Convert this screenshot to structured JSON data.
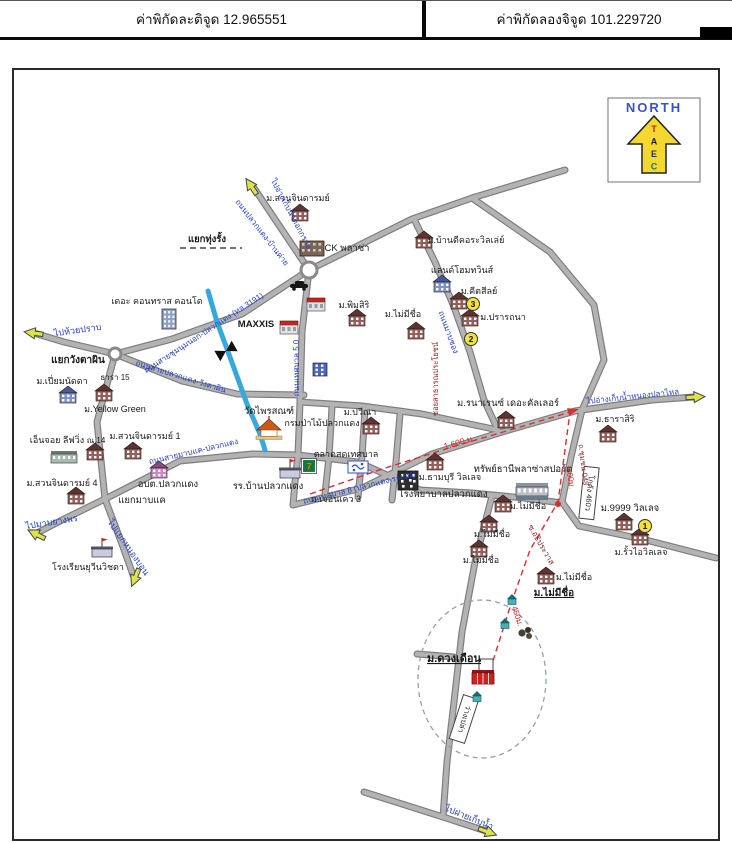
{
  "header": {
    "lat": "ค่าพิกัดละติจูด 12.965551",
    "lon": "ค่าพิกัดลองจิจูด 101.229720"
  },
  "north_box": {
    "title": "NORTH",
    "title_color": "#3a50c8",
    "arrow_color": "#f4d830",
    "letters": [
      "T",
      "A",
      "E",
      "C"
    ],
    "letter_colors": [
      "#c22222",
      "#222222",
      "#223366",
      "#0a7a7a"
    ]
  },
  "map": {
    "colors": {
      "road_fill": "#b3b3b3",
      "road_edge": "#7e7e7e",
      "stream": "#35a8de",
      "blue_text": "#2440c8",
      "maroon_text": "#8a2a2a",
      "red_text": "#e02020",
      "black_text": "#1a1a1a",
      "route_dash": "#d63030",
      "circle_dash": "#8fa0b4",
      "arrow_fill": "#dbe24c",
      "badge_fill": "#f2e23a"
    },
    "roads": [
      {
        "pts": [
          [
            563,
            168
          ],
          [
            470,
            196
          ],
          [
            410,
            217
          ],
          [
            307,
            268
          ]
        ]
      },
      {
        "pts": [
          [
            252,
            186
          ],
          [
            307,
            268
          ]
        ]
      },
      {
        "pts": [
          [
            307,
            268
          ],
          [
            240,
            312
          ],
          [
            170,
            337
          ],
          [
            113,
            352
          ]
        ]
      },
      {
        "pts": [
          [
            113,
            352
          ],
          [
            62,
            340
          ],
          [
            32,
            331
          ]
        ]
      },
      {
        "pts": [
          [
            113,
            352
          ],
          [
            95,
            420
          ],
          [
            103,
            497
          ]
        ]
      },
      {
        "pts": [
          [
            103,
            497
          ],
          [
            62,
            517
          ],
          [
            35,
            531
          ]
        ]
      },
      {
        "pts": [
          [
            103,
            497
          ],
          [
            120,
            542
          ],
          [
            131,
            573
          ]
        ]
      },
      {
        "pts": [
          [
            103,
            497
          ],
          [
            178,
            459
          ],
          [
            250,
            452
          ],
          [
            298,
            453
          ]
        ]
      },
      {
        "pts": [
          [
            113,
            352
          ],
          [
            180,
            379
          ],
          [
            235,
            392
          ],
          [
            302,
            393
          ]
        ]
      },
      {
        "pts": [
          [
            307,
            268
          ],
          [
            300,
            330
          ],
          [
            298,
            400
          ],
          [
            296,
            453
          ],
          [
            293,
            480
          ],
          [
            291,
            503
          ]
        ]
      },
      {
        "pts": [
          [
            291,
            503
          ],
          [
            360,
            486
          ],
          [
            430,
            452
          ],
          [
            500,
            430
          ],
          [
            573,
            409
          ],
          [
            650,
            398
          ],
          [
            692,
            395
          ]
        ]
      },
      {
        "pts": [
          [
            412,
            217
          ],
          [
            433,
            260
          ],
          [
            452,
            305
          ],
          [
            468,
            350
          ],
          [
            482,
            398
          ],
          [
            496,
            428
          ]
        ]
      },
      {
        "pts": [
          [
            470,
            196
          ],
          [
            548,
            250
          ],
          [
            592,
            303
          ],
          [
            602,
            358
          ],
          [
            580,
            408
          ]
        ]
      },
      {
        "pts": [
          [
            580,
            408
          ],
          [
            569,
            455
          ],
          [
            560,
            500
          ]
        ]
      },
      {
        "pts": [
          [
            560,
            500
          ],
          [
            577,
            524
          ],
          [
            640,
            537
          ],
          [
            714,
            556
          ]
        ]
      },
      {
        "pts": [
          [
            490,
            494
          ],
          [
            473,
            560
          ],
          [
            460,
            630
          ],
          [
            452,
            700
          ],
          [
            445,
            760
          ],
          [
            441,
            815
          ]
        ]
      },
      {
        "pts": [
          [
            418,
            488
          ],
          [
            470,
            491
          ],
          [
            522,
            496
          ],
          [
            560,
            501
          ]
        ]
      },
      {
        "pts": [
          [
            362,
            790
          ],
          [
            441,
            815
          ],
          [
            484,
            829
          ]
        ]
      },
      {
        "pts": [
          [
            452,
            655
          ],
          [
            415,
            652
          ]
        ]
      },
      {
        "pts": [
          [
            298,
            400
          ],
          [
            360,
            404
          ],
          [
            420,
            412
          ],
          [
            496,
            428
          ]
        ]
      },
      {
        "pts": [
          [
            330,
            405
          ],
          [
            327,
            455
          ],
          [
            323,
            492
          ]
        ]
      },
      {
        "pts": [
          [
            363,
            408
          ],
          [
            360,
            455
          ],
          [
            356,
            495
          ]
        ]
      },
      {
        "pts": [
          [
            398,
            412
          ],
          [
            394,
            460
          ],
          [
            390,
            498
          ]
        ]
      },
      {
        "pts": [
          [
            296,
            453
          ],
          [
            356,
            460
          ],
          [
            418,
            488
          ]
        ]
      }
    ],
    "stream": {
      "pts": [
        [
          206,
          289
        ],
        [
          215,
          320
        ],
        [
          228,
          355
        ],
        [
          245,
          402
        ],
        [
          258,
          432
        ],
        [
          263,
          448
        ]
      ]
    },
    "bridge": {
      "x": 224,
      "y": 349,
      "a": -30
    },
    "junctions": [
      {
        "x": 307,
        "y": 268,
        "r": 8
      },
      {
        "x": 113,
        "y": 352,
        "r": 6
      }
    ],
    "dash_circle": {
      "cx": 480,
      "cy": 677,
      "rx": 64,
      "ry": 79
    },
    "route": {
      "pts": [
        [
          308,
          492
        ],
        [
          380,
          467
        ],
        [
          450,
          445
        ],
        [
          525,
          423
        ],
        [
          568,
          410
        ],
        [
          562,
          455
        ],
        [
          556,
          500
        ],
        [
          528,
          548
        ],
        [
          509,
          602
        ],
        [
          490,
          662
        ],
        [
          486,
          674
        ]
      ],
      "dot": {
        "x": 556,
        "y": 502
      },
      "heads": [
        {
          "x": 570,
          "y": 409,
          "a": -15
        },
        {
          "x": 487,
          "y": 678,
          "a": 195
        }
      ]
    },
    "extras": {
      "dash_underline": [
        [
          178,
          246
        ],
        [
          240,
          246
        ]
      ]
    },
    "boxes": [
      {
        "t": "โกดัง 460ว",
        "x": 587,
        "y": 491,
        "w": 15,
        "h": 52,
        "r": 6
      },
      {
        "t": "ว่างเปล่า",
        "x": 462,
        "y": 717,
        "w": 16,
        "h": 46,
        "r": 18
      }
    ],
    "badges": [
      {
        "n": "1",
        "x": 643,
        "y": 524
      },
      {
        "n": "2",
        "x": 469,
        "y": 337
      },
      {
        "n": "3",
        "x": 471,
        "y": 302
      }
    ],
    "arrows": [
      {
        "x": 249,
        "y": 184,
        "a": -124
      },
      {
        "x": 31,
        "y": 331,
        "a": 188
      },
      {
        "x": 34,
        "y": 532,
        "a": 207
      },
      {
        "x": 133,
        "y": 576,
        "a": 112
      },
      {
        "x": 694,
        "y": 395,
        "a": -3
      },
      {
        "x": 486,
        "y": 830,
        "a": 20
      }
    ],
    "icons": [
      {
        "k": "building",
        "x": 298,
        "y": 214
      },
      {
        "k": "big",
        "x": 310,
        "y": 247
      },
      {
        "k": "condo",
        "x": 167,
        "y": 317
      },
      {
        "k": "building",
        "x": 355,
        "y": 319
      },
      {
        "k": "shopred",
        "x": 287,
        "y": 327
      },
      {
        "k": "bluebld",
        "x": 66,
        "y": 396
      },
      {
        "k": "building",
        "x": 102,
        "y": 394
      },
      {
        "k": "building",
        "x": 131,
        "y": 452
      },
      {
        "k": "longbld",
        "x": 62,
        "y": 456
      },
      {
        "k": "building",
        "x": 93,
        "y": 453
      },
      {
        "k": "pinkbld",
        "x": 157,
        "y": 471
      },
      {
        "k": "building",
        "x": 74,
        "y": 497
      },
      {
        "k": "school",
        "x": 100,
        "y": 550
      },
      {
        "k": "temple",
        "x": 267,
        "y": 431
      },
      {
        "k": "building",
        "x": 369,
        "y": 427
      },
      {
        "k": "market",
        "x": 356,
        "y": 465
      },
      {
        "k": "seven",
        "x": 307,
        "y": 464
      },
      {
        "k": "school",
        "x": 288,
        "y": 471
      },
      {
        "k": "hospital",
        "x": 406,
        "y": 479
      },
      {
        "k": "building",
        "x": 433,
        "y": 463
      },
      {
        "k": "building",
        "x": 504,
        "y": 421
      },
      {
        "k": "sport",
        "x": 530,
        "y": 489
      },
      {
        "k": "building",
        "x": 606,
        "y": 435
      },
      {
        "k": "building",
        "x": 622,
        "y": 523
      },
      {
        "k": "building",
        "x": 638,
        "y": 538
      },
      {
        "k": "building",
        "x": 414,
        "y": 332
      },
      {
        "k": "building",
        "x": 501,
        "y": 505
      },
      {
        "k": "building",
        "x": 487,
        "y": 525
      },
      {
        "k": "building",
        "x": 477,
        "y": 550
      },
      {
        "k": "building",
        "x": 544,
        "y": 577
      },
      {
        "k": "building",
        "x": 422,
        "y": 241
      },
      {
        "k": "bluebld",
        "x": 440,
        "y": 285
      },
      {
        "k": "building",
        "x": 457,
        "y": 302
      },
      {
        "k": "building",
        "x": 468,
        "y": 319
      },
      {
        "k": "car",
        "x": 297,
        "y": 284
      },
      {
        "k": "shopred",
        "x": 314,
        "y": 304
      },
      {
        "k": "govblue",
        "x": 318,
        "y": 368
      },
      {
        "k": "house",
        "x": 510,
        "y": 598
      },
      {
        "k": "house",
        "x": 503,
        "y": 622
      },
      {
        "k": "house",
        "x": 475,
        "y": 695
      },
      {
        "k": "grove",
        "x": 524,
        "y": 631
      },
      {
        "k": "target",
        "x": 481,
        "y": 674
      }
    ],
    "labels": [
      {
        "t": "ม.สวนจินดารมย์",
        "x": 296,
        "y": 199
      },
      {
        "t": "CK พลาซ่า",
        "x": 345,
        "y": 249,
        "s": 9.5
      },
      {
        "t": "แยกทุ่งรั้ง",
        "x": 205,
        "y": 240,
        "w": 1,
        "s": 9.5
      },
      {
        "t": "เดอะ คอนทราส คอนโด",
        "x": 155,
        "y": 302
      },
      {
        "t": "ม.พิมสิริ",
        "x": 352,
        "y": 306
      },
      {
        "t": "MAXXIS",
        "x": 254,
        "y": 325,
        "w": 1,
        "s": 9.5
      },
      {
        "t": "แยกวังตาผิน",
        "x": 76,
        "y": 361,
        "w": 1,
        "s": 10
      },
      {
        "t": "ธารา 15",
        "x": 113,
        "y": 378,
        "s": 8
      },
      {
        "t": "ม.เปี่ยมนัดดา",
        "x": 60,
        "y": 382
      },
      {
        "t": "ม.Yellow Green",
        "x": 113,
        "y": 410
      },
      {
        "t": "เอ็นจอย ลีฟวิ่ง",
        "x": 55,
        "y": 441
      },
      {
        "t": "ณ.14",
        "x": 94,
        "y": 441,
        "s": 8
      },
      {
        "t": "ม.สวนจินดารมย์ 1",
        "x": 143,
        "y": 437
      },
      {
        "t": "อบต.ปลวกแดง",
        "x": 166,
        "y": 485,
        "s": 9.5
      },
      {
        "t": "ม.สวนจินดารมย์ 4",
        "x": 60,
        "y": 484
      },
      {
        "t": "แยกมาบแค",
        "x": 140,
        "y": 501,
        "s": 9.5
      },
      {
        "t": "โรงเรียนยุวีนวิชตา",
        "x": 86,
        "y": 568
      },
      {
        "t": "วัดไพรสณฑ์",
        "x": 267,
        "y": 412,
        "s": 9.5
      },
      {
        "t": "กรมป่าไม้ปลวกแดง",
        "x": 320,
        "y": 424
      },
      {
        "t": "ม.ปวีณา",
        "x": 358,
        "y": 413
      },
      {
        "t": "ตลาดสดเทศบาล",
        "x": 344,
        "y": 455
      },
      {
        "t": "รร.บ้านปลวกแดง",
        "x": 266,
        "y": 487,
        "s": 9.5
      },
      {
        "t": "ม.เจอันเคว 3",
        "x": 334,
        "y": 500
      },
      {
        "t": "โรงพยาบาลปลวกแดง",
        "x": 441,
        "y": 495,
        "s": 9.5
      },
      {
        "t": "ม.ธามบุรี วิลเลจ",
        "x": 448,
        "y": 478
      },
      {
        "t": "ม.รนาเรนซ์ เดอะคัลเลอร์",
        "x": 506,
        "y": 404,
        "s": 9.5
      },
      {
        "t": "ทรัพย์ธานีพลาซ่าสปอร์ต",
        "x": 521,
        "y": 470,
        "s": 9.5
      },
      {
        "t": "ม.ธาราสิริ",
        "x": 613,
        "y": 420
      },
      {
        "t": "ม.9999 วิลเลจ",
        "x": 628,
        "y": 509,
        "s": 9.5
      },
      {
        "t": "ม.รั้วไอวิลเลจ",
        "x": 639,
        "y": 553
      },
      {
        "t": "ม.ไม่มีชื่อ",
        "x": 401,
        "y": 315
      },
      {
        "t": "ม.ไม่มีชื่อ",
        "x": 526,
        "y": 507
      },
      {
        "t": "ม.ไม่มีชื่อ",
        "x": 490,
        "y": 535
      },
      {
        "t": "ม.ไม่มีชื่อ",
        "x": 479,
        "y": 561
      },
      {
        "t": "ม.ไม่มีชื่อ",
        "x": 572,
        "y": 578
      },
      {
        "t": "ม.ไม่มีชื่อ",
        "x": 552,
        "y": 594,
        "w": 1,
        "u": 1,
        "s": 10
      },
      {
        "t": "ม.ดวงเดือน",
        "x": 452,
        "y": 660,
        "w": 1,
        "u": 1,
        "s": 11
      },
      {
        "t": "ม.บ้านดีคอระวิลเล่ย์",
        "x": 464,
        "y": 241
      },
      {
        "t": "แลนด์โฮมทวินส์",
        "x": 460,
        "y": 271
      },
      {
        "t": "ม.คีตสีลย์",
        "x": 477,
        "y": 292
      },
      {
        "t": "ม.ปรารถนา",
        "x": 501,
        "y": 318
      },
      {
        "t": "ถนนปลวกแดง-บ้านค่าย",
        "x": 258,
        "y": 232,
        "r": 52,
        "c": "#2440c8",
        "s": 8
      },
      {
        "t": "ไปอ่างเก็บน้ำดอกกราย",
        "x": 287,
        "y": 213,
        "r": 62,
        "c": "#2440c8",
        "s": 8
      },
      {
        "t": "ไปห้วยปราบ",
        "x": 76,
        "y": 331,
        "r": -8,
        "c": "#2440c8"
      },
      {
        "t": "ถนนสายชุมนุมนอก-ปลวกแดง (ทล.3191)",
        "x": 203,
        "y": 333,
        "r": -33,
        "c": "#2440c8",
        "s": 8
      },
      {
        "t": "ถนนสายปลวกแดง-วังตาผิน",
        "x": 178,
        "y": 377,
        "r": 17,
        "c": "#2440c8",
        "s": 8
      },
      {
        "t": "ถนนเทศบาล 5.0",
        "x": 297,
        "y": 366,
        "r": -90,
        "c": "#2440c8",
        "s": 8
      },
      {
        "t": "ถนนสายมาบแค-ปลวกแดง",
        "x": 192,
        "y": 452,
        "r": -13,
        "c": "#2440c8",
        "s": 8
      },
      {
        "t": "ถนนเทศบาล 8 (ปลวกแดง-ระยอง)",
        "x": 358,
        "y": 488,
        "r": -14,
        "c": "#2440c8",
        "s": 8
      },
      {
        "t": "ไปอ่างเก็บน้ำหนองปลาไหล",
        "x": 631,
        "y": 397,
        "r": -6,
        "c": "#2440c8",
        "s": 8
      },
      {
        "t": "ไปมาบยางพร",
        "x": 50,
        "y": 523,
        "r": -9,
        "c": "#2440c8"
      },
      {
        "t": "ไปแยกหนองบอน",
        "x": 124,
        "y": 547,
        "r": 55,
        "c": "#2440c8"
      },
      {
        "t": "ไปฝายเก็บน้ำ",
        "x": 466,
        "y": 818,
        "r": 22,
        "c": "#2440c8"
      },
      {
        "t": "ถนนมาบชอง",
        "x": 444,
        "y": 331,
        "r": 70,
        "c": "#2440c8",
        "s": 8
      },
      {
        "t": "ซอยสาธารณประโยชน์",
        "x": 436,
        "y": 377,
        "r": -90,
        "c": "#8a2a2a",
        "s": 7.5
      },
      {
        "t": "ซ.อธิประวาส",
        "x": 537,
        "y": 544,
        "r": 60,
        "c": "#8a2a2a",
        "s": 8
      },
      {
        "t": "ถ.ชุมชน 048",
        "x": 579,
        "y": 463,
        "r": 83,
        "c": "#8a2a2a",
        "s": 7.5
      },
      {
        "t": "1,600 ม.",
        "x": 458,
        "y": 443,
        "r": -16,
        "c": "#e02020",
        "s": 8.5
      },
      {
        "t": "600ม.",
        "x": 566,
        "y": 477,
        "r": 80,
        "c": "#e02020",
        "s": 8
      },
      {
        "t": "450ม.",
        "x": 513,
        "y": 615,
        "r": 72,
        "c": "#e02020",
        "s": 8
      }
    ]
  }
}
